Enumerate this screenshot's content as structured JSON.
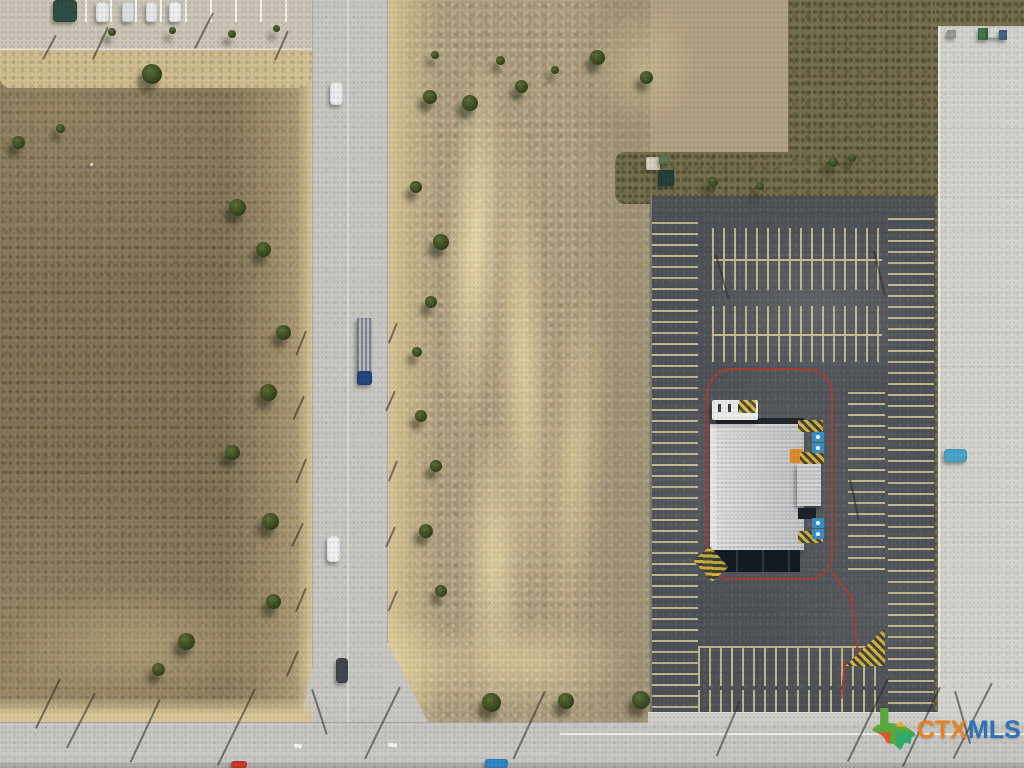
{
  "meta": {
    "type": "aerial-photo",
    "description": "Aerial drone view of a vacant commercial land parcel beside a concrete road, with a large asphalt parking lot and white-roofed retail building on the right, scrub fields on the left, and a highway along the bottom edge."
  },
  "watermark": {
    "ctx": "CTX",
    "mls": "MLS",
    "ctx_color": "#E8821E",
    "mls_color": "#2B74B8",
    "texas": {
      "top_left": "#58A83C",
      "top_right": "#F2A73B",
      "bottom_left": "#E05829",
      "bottom_right": "#2FA86C"
    }
  },
  "scene": {
    "colors": {
      "field_left": "#84755a",
      "field_center": "#b2a284",
      "soil_light": "#e8dbb0",
      "scrub_dark": "#77704f",
      "road": "#c8c7c3",
      "shoulder": "#d9c597",
      "asphalt": "#4e5257",
      "concrete": "#d4d3ce",
      "stall_line": "#ddcf9b",
      "curb_red": "#b5392c",
      "roof_light": "#d9dadb",
      "roof_dark": "#23262c",
      "pavement": "#cdc6b8",
      "sidewalk": "#cfcec9",
      "tree_dark": "#3c4b23"
    },
    "trees": [
      {
        "x": 152,
        "y": 74,
        "s": 20
      },
      {
        "x": 237,
        "y": 207,
        "s": 17
      },
      {
        "x": 263,
        "y": 249,
        "s": 15
      },
      {
        "x": 283,
        "y": 332,
        "s": 15
      },
      {
        "x": 268,
        "y": 392,
        "s": 17
      },
      {
        "x": 232,
        "y": 452,
        "s": 15
      },
      {
        "x": 270,
        "y": 521,
        "s": 17
      },
      {
        "x": 273,
        "y": 601,
        "s": 15
      },
      {
        "x": 186,
        "y": 641,
        "s": 17
      },
      {
        "x": 158,
        "y": 669,
        "s": 13
      },
      {
        "x": 18,
        "y": 142,
        "s": 13
      },
      {
        "x": 60,
        "y": 128,
        "s": 9
      },
      {
        "x": 430,
        "y": 97,
        "s": 14
      },
      {
        "x": 470,
        "y": 103,
        "s": 16
      },
      {
        "x": 521,
        "y": 86,
        "s": 13
      },
      {
        "x": 597,
        "y": 57,
        "s": 15
      },
      {
        "x": 646,
        "y": 77,
        "s": 13
      },
      {
        "x": 416,
        "y": 187,
        "s": 12
      },
      {
        "x": 441,
        "y": 242,
        "s": 16
      },
      {
        "x": 431,
        "y": 302,
        "s": 12
      },
      {
        "x": 417,
        "y": 352,
        "s": 10
      },
      {
        "x": 421,
        "y": 416,
        "s": 12
      },
      {
        "x": 436,
        "y": 466,
        "s": 12
      },
      {
        "x": 426,
        "y": 531,
        "s": 14
      },
      {
        "x": 441,
        "y": 591,
        "s": 12
      },
      {
        "x": 491,
        "y": 702,
        "s": 19
      },
      {
        "x": 566,
        "y": 701,
        "s": 16
      },
      {
        "x": 641,
        "y": 700,
        "s": 18
      },
      {
        "x": 713,
        "y": 182,
        "s": 10
      },
      {
        "x": 833,
        "y": 162,
        "s": 10
      },
      {
        "x": 760,
        "y": 186,
        "s": 8
      },
      {
        "x": 852,
        "y": 158,
        "s": 8
      },
      {
        "x": 112,
        "y": 32,
        "s": 8
      },
      {
        "x": 172,
        "y": 30,
        "s": 7
      },
      {
        "x": 232,
        "y": 34,
        "s": 8
      },
      {
        "x": 276,
        "y": 28,
        "s": 7
      },
      {
        "x": 435,
        "y": 55,
        "s": 8
      },
      {
        "x": 500,
        "y": 60,
        "s": 9
      },
      {
        "x": 555,
        "y": 70,
        "s": 8
      }
    ],
    "objects": [
      {
        "name": "pickup-truck",
        "x": 53,
        "y": 0,
        "w": 24,
        "h": 22,
        "color": "#2f4f44",
        "r": 4
      },
      {
        "name": "parked-car",
        "x": 96,
        "y": 2,
        "w": 13,
        "h": 20,
        "color": "#e8eaec",
        "r": 3
      },
      {
        "name": "parked-car",
        "x": 122,
        "y": 2,
        "w": 12,
        "h": 20,
        "color": "#dde0e3",
        "r": 3
      },
      {
        "name": "parked-car",
        "x": 146,
        "y": 2,
        "w": 11,
        "h": 20,
        "color": "#e6e8ea",
        "r": 3
      },
      {
        "name": "parked-car",
        "x": 169,
        "y": 2,
        "w": 12,
        "h": 20,
        "color": "#eef0f1",
        "r": 3
      },
      {
        "name": "car-on-road",
        "x": 330,
        "y": 82,
        "w": 13,
        "h": 23,
        "color": "#ecedee",
        "r": 4
      },
      {
        "name": "semi-trailer",
        "x": 357,
        "y": 318,
        "w": 15,
        "h": 55,
        "color": "#b6bac0",
        "r": 1,
        "stripes": true
      },
      {
        "name": "truck-cab",
        "x": 357,
        "y": 371,
        "w": 15,
        "h": 14,
        "color": "#24457e",
        "r": 3
      },
      {
        "name": "car-on-road",
        "x": 327,
        "y": 536,
        "w": 13,
        "h": 26,
        "color": "#f0f1f2",
        "r": 4
      },
      {
        "name": "car-on-road",
        "x": 336,
        "y": 658,
        "w": 12,
        "h": 25,
        "color": "#43464c",
        "r": 4
      },
      {
        "name": "red-car",
        "x": 231,
        "y": 761,
        "w": 16,
        "h": 7,
        "color": "#d03a2e",
        "r": 3
      },
      {
        "name": "blue-car",
        "x": 485,
        "y": 759,
        "w": 23,
        "h": 9,
        "color": "#2f87c5",
        "r": 3
      },
      {
        "name": "teal-car",
        "x": 944,
        "y": 449,
        "w": 23,
        "h": 13,
        "color": "#49a7c9",
        "r": 4
      },
      {
        "name": "dumpster",
        "x": 658,
        "y": 170,
        "w": 16,
        "h": 16,
        "color": "#26403a",
        "r": 1
      },
      {
        "name": "shed",
        "x": 646,
        "y": 157,
        "w": 14,
        "h": 13,
        "color": "#d8d0be",
        "r": 1
      },
      {
        "name": "shed-roof",
        "x": 659,
        "y": 155,
        "w": 10,
        "h": 9,
        "color": "#5a7a50",
        "r": 1
      },
      {
        "name": "equipment",
        "x": 947,
        "y": 30,
        "w": 9,
        "h": 8,
        "color": "#9aa096",
        "r": 1
      },
      {
        "name": "equipment",
        "x": 978,
        "y": 28,
        "w": 10,
        "h": 12,
        "color": "#3f7a46",
        "r": 1
      },
      {
        "name": "equipment",
        "x": 988,
        "y": 26,
        "w": 12,
        "h": 12,
        "color": "#d5d7d2",
        "r": 1
      },
      {
        "name": "equipment",
        "x": 999,
        "y": 30,
        "w": 8,
        "h": 10,
        "color": "#44618a",
        "r": 1
      },
      {
        "name": "debris",
        "x": 90,
        "y": 163,
        "w": 3,
        "h": 3,
        "color": "#f0f0ea",
        "r": 1
      }
    ],
    "pole_shadows": [
      {
        "x": 108,
        "y": 26,
        "len": 36,
        "deg": 115
      },
      {
        "x": 213,
        "y": 12,
        "len": 40,
        "deg": 117
      },
      {
        "x": 288,
        "y": 30,
        "len": 32,
        "deg": 114
      },
      {
        "x": 56,
        "y": 34,
        "len": 28,
        "deg": 118
      },
      {
        "x": 306,
        "y": 330,
        "len": 26,
        "deg": 112
      },
      {
        "x": 304,
        "y": 395,
        "len": 26,
        "deg": 114
      },
      {
        "x": 306,
        "y": 458,
        "len": 26,
        "deg": 112
      },
      {
        "x": 303,
        "y": 522,
        "len": 26,
        "deg": 115
      },
      {
        "x": 306,
        "y": 587,
        "len": 26,
        "deg": 113
      },
      {
        "x": 298,
        "y": 650,
        "len": 28,
        "deg": 114
      },
      {
        "x": 397,
        "y": 322,
        "len": 22,
        "deg": 112
      },
      {
        "x": 395,
        "y": 390,
        "len": 22,
        "deg": 114
      },
      {
        "x": 397,
        "y": 460,
        "len": 22,
        "deg": 112
      },
      {
        "x": 395,
        "y": 526,
        "len": 22,
        "deg": 114
      },
      {
        "x": 397,
        "y": 590,
        "len": 22,
        "deg": 113
      },
      {
        "x": 95,
        "y": 692,
        "len": 62,
        "deg": 117
      },
      {
        "x": 160,
        "y": 698,
        "len": 70,
        "deg": 115
      },
      {
        "x": 255,
        "y": 688,
        "len": 85,
        "deg": 116
      },
      {
        "x": 400,
        "y": 686,
        "len": 80,
        "deg": 116
      },
      {
        "x": 545,
        "y": 690,
        "len": 75,
        "deg": 115
      },
      {
        "x": 740,
        "y": 700,
        "len": 60,
        "deg": 113
      },
      {
        "x": 888,
        "y": 678,
        "len": 92,
        "deg": 116
      },
      {
        "x": 940,
        "y": 686,
        "len": 88,
        "deg": 115
      },
      {
        "x": 992,
        "y": 682,
        "len": 85,
        "deg": 117
      },
      {
        "x": 60,
        "y": 678,
        "len": 55,
        "deg": 116
      },
      {
        "x": 312,
        "y": 688,
        "len": 48,
        "deg": 72
      },
      {
        "x": 955,
        "y": 690,
        "len": 55,
        "deg": 74
      },
      {
        "x": 716,
        "y": 254,
        "len": 46,
        "deg": 74
      },
      {
        "x": 874,
        "y": 250,
        "len": 46,
        "deg": 76
      },
      {
        "x": 850,
        "y": 478,
        "len": 42,
        "deg": 78
      }
    ]
  }
}
